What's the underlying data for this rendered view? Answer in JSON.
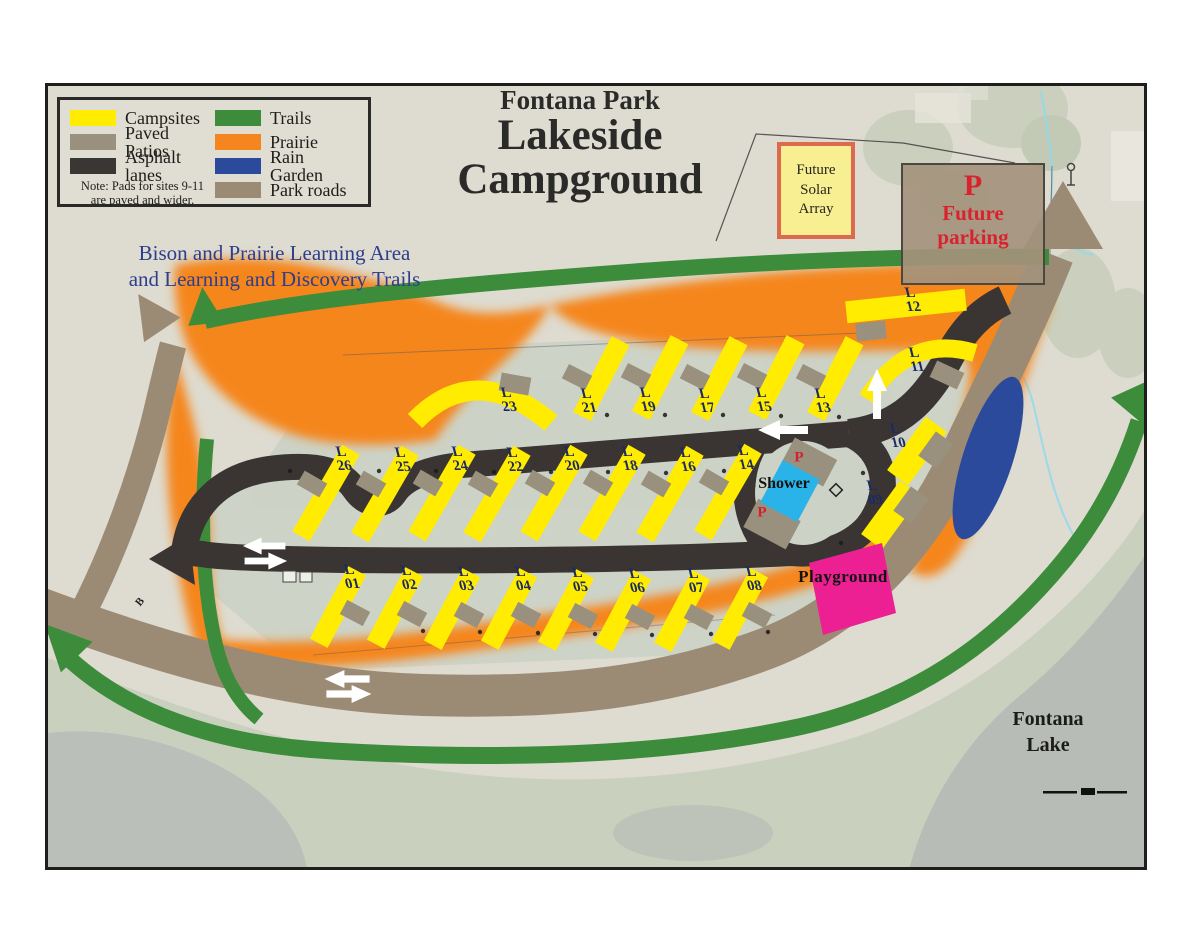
{
  "title": {
    "supertitle": "Fontana Park",
    "line1": "Lakeside",
    "line2": "Campground"
  },
  "legend": {
    "items": [
      {
        "label": "Campsites",
        "color": "#ffec00"
      },
      {
        "label": "Paved Patios",
        "color": "#99917e"
      },
      {
        "label": "Asphalt lanes",
        "color": "#3a3634"
      },
      {
        "label": "Trails",
        "color": "#3c8c3c"
      },
      {
        "label": "Prairie",
        "color": "#f5861f"
      },
      {
        "label": "Rain Garden",
        "color": "#2c4a9b"
      },
      {
        "label": "Park roads",
        "color": "#9c8b74"
      }
    ],
    "note": "Note: Pads for sites 9-11\nare paved and wider."
  },
  "annotations": {
    "learning_area": "Bison and Prairie Learning Area\nand Learning and Discovery Trails",
    "future_solar_array": "Future\nSolar\nArray",
    "future_parking_p": "P",
    "future_parking": "Future\nparking",
    "shower": "Shower",
    "shower_parking_north": "P",
    "shower_parking_south": "P",
    "playground": "Playground",
    "lake_name": "Fontana\nLake",
    "road_marker_b": "B"
  },
  "sites": [
    {
      "label": "L\n01"
    },
    {
      "label": "L\n02"
    },
    {
      "label": "L\n03"
    },
    {
      "label": "L\n04"
    },
    {
      "label": "L\n05"
    },
    {
      "label": "L\n06"
    },
    {
      "label": "L\n07"
    },
    {
      "label": "L\n08"
    },
    {
      "label": "L\n09"
    },
    {
      "label": "L\n10"
    },
    {
      "label": "L\n11"
    },
    {
      "label": "L\n12"
    },
    {
      "label": "L\n13"
    },
    {
      "label": "L\n14"
    },
    {
      "label": "L\n15"
    },
    {
      "label": "L\n16"
    },
    {
      "label": "L\n17"
    },
    {
      "label": "L\n18"
    },
    {
      "label": "L\n19"
    },
    {
      "label": "L\n20"
    },
    {
      "label": "L\n21"
    },
    {
      "label": "L\n22"
    },
    {
      "label": "L\n23"
    },
    {
      "label": "L\n24"
    },
    {
      "label": "L\n25"
    },
    {
      "label": "L\n26"
    }
  ],
  "colors": {
    "map_background": "#dedbd0",
    "campground_ground": "#ccd2c6",
    "lake": "#b6bab6",
    "trees": "#c2cdb8",
    "shower_building": "#2ab3e8",
    "playground": "#ec1f93",
    "red_text": "#d8232e",
    "blue_text": "#2d3e8d",
    "site_label_text": "#1b2a63",
    "solar_box_fill": "#f8ee92",
    "solar_box_border": "#dd6a4e"
  }
}
